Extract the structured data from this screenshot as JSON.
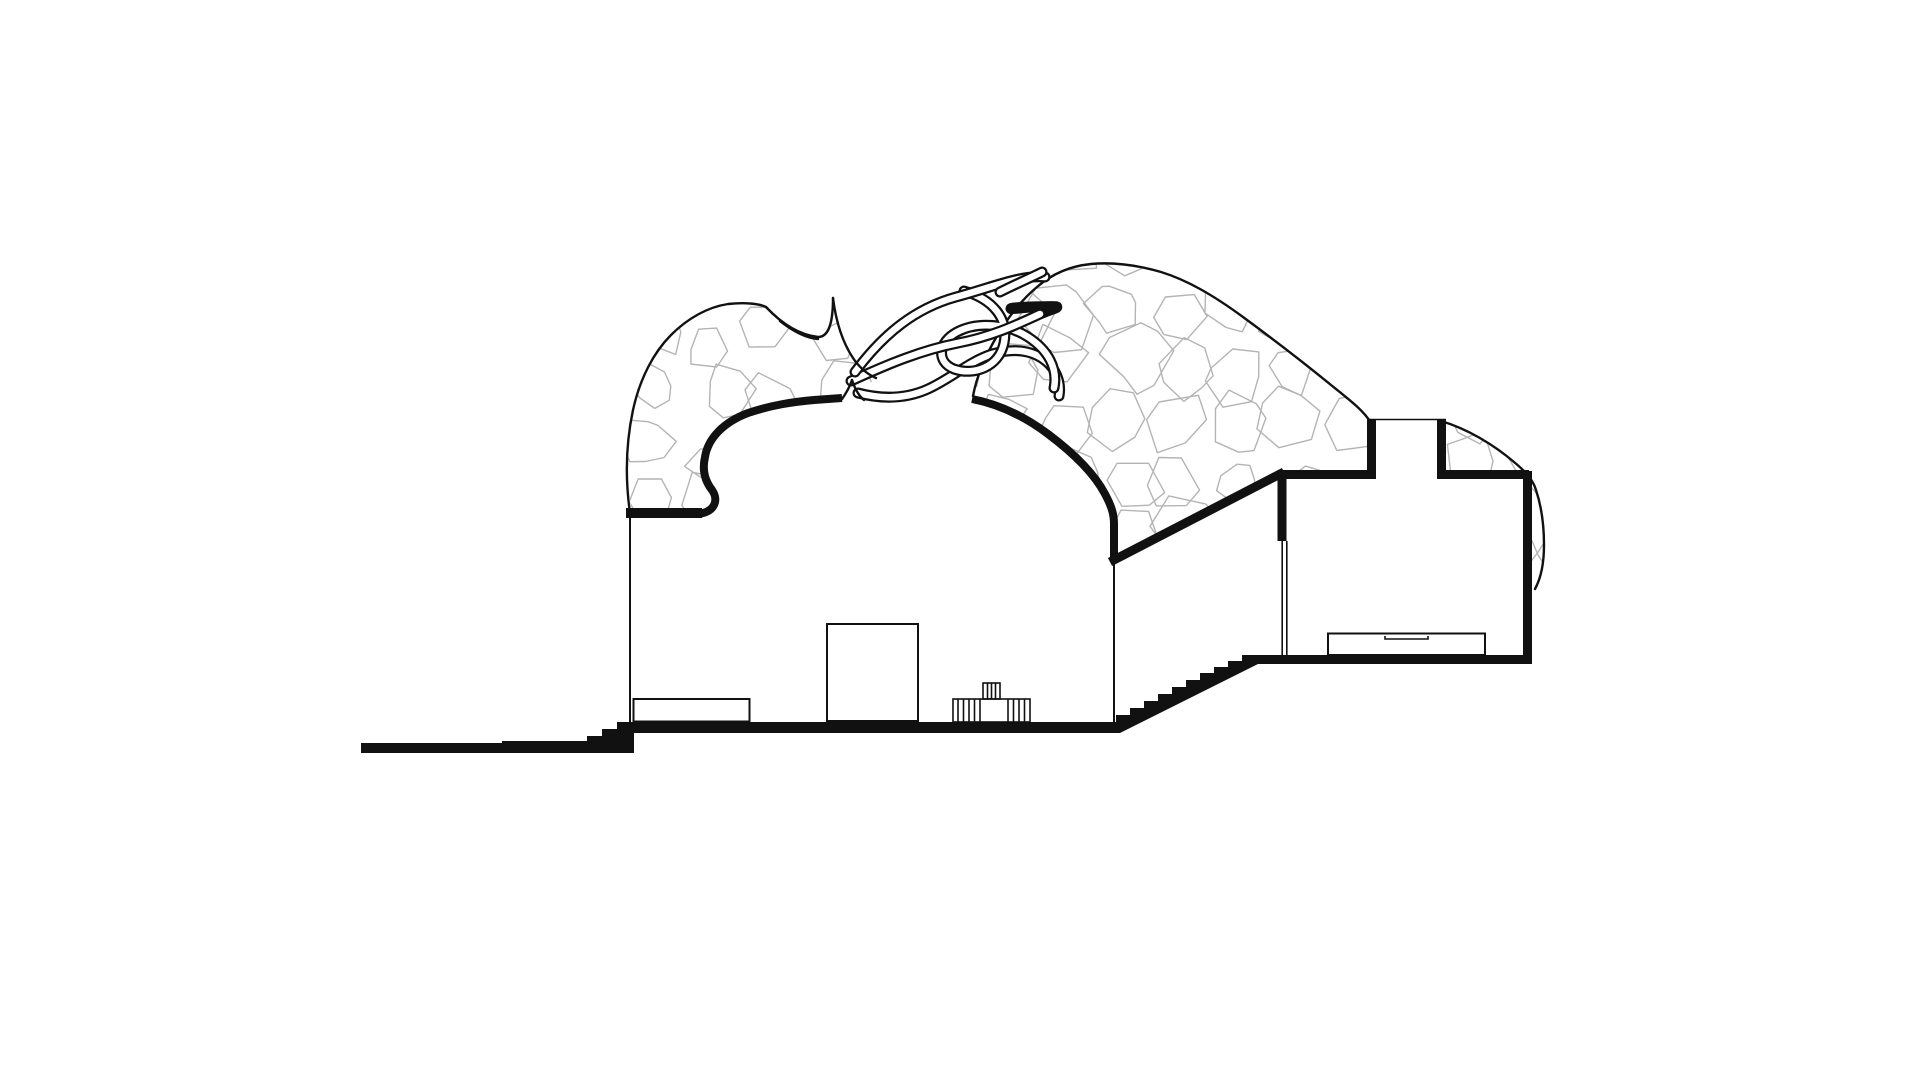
{
  "canvas": {
    "width": 1920,
    "height": 1080
  },
  "colors": {
    "background": "#ffffff",
    "ink": "#111111",
    "stone_pattern": "#b4b4b4",
    "tube_fill": "#ffffff"
  },
  "figure": {
    "kind": "architectural-section-drawing",
    "style": "black ink section on white, no text or dimensions visible",
    "elements": [
      "left rock mass filled with polygonal stone pattern",
      "right rock mass filled with polygonal stone pattern",
      "woven root tubes bridging the two rock masses",
      "bell-shaped dome hall cut with thick poche",
      "door opening rectangle inside dome hall",
      "low plinth at left wall",
      "small fluted stool on dome floor",
      "staircase of ten steps rising to the right",
      "upper side room with roof skylight notch",
      "low sideboard inside side room",
      "open door leaf at side room entry",
      "stepped ground line running to the left"
    ]
  },
  "pattern": {
    "seed_left": 11,
    "seed_right": 29,
    "seed_edge": 53,
    "grid_step": 58
  }
}
